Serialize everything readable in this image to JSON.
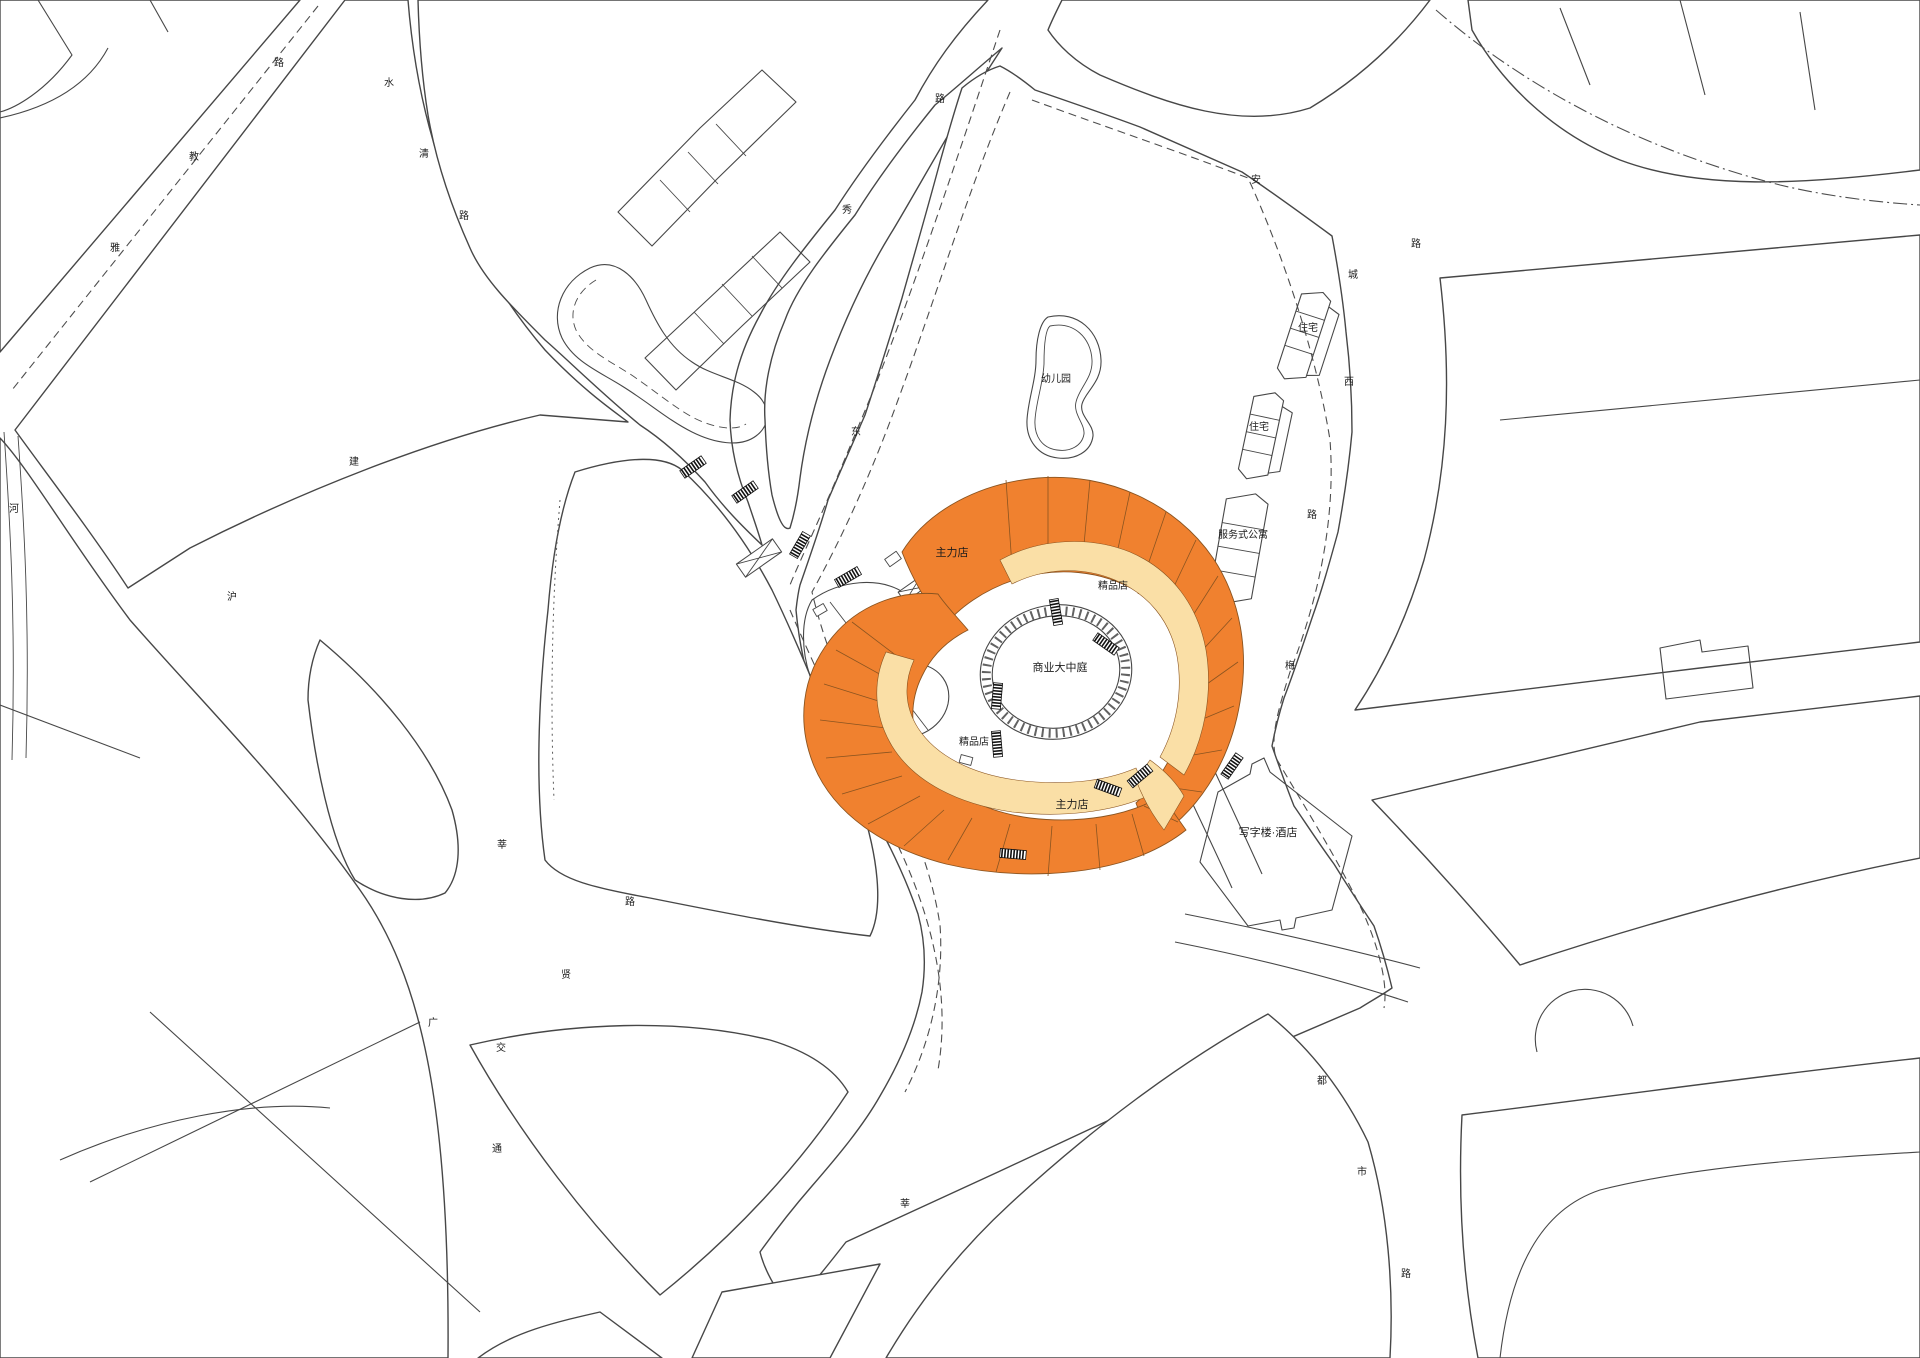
{
  "title": "commercial-complex-site-plan",
  "colors": {
    "orange": "#F0812F",
    "cream": "#FADFA6",
    "line": "#474747"
  },
  "mall": {
    "atrium_label": "商业大中庭",
    "anchor_store_label": "主力店",
    "boutique_label": "精品店"
  },
  "site_labels": [
    {
      "text": "幼儿园",
      "x": 1056,
      "y": 382,
      "size": 10
    },
    {
      "text": "住宅",
      "x": 1308,
      "y": 331,
      "size": 10
    },
    {
      "text": "住宅",
      "x": 1259,
      "y": 430,
      "size": 10
    },
    {
      "text": "服务式公寓",
      "x": 1243,
      "y": 538,
      "size": 10
    },
    {
      "text": "写字楼·酒店",
      "x": 1268,
      "y": 836,
      "size": 11
    },
    {
      "text": "主力店",
      "x": 952,
      "y": 556,
      "size": 11
    },
    {
      "text": "精品店",
      "x": 1113,
      "y": 589,
      "size": 10
    },
    {
      "text": "商业大中庭",
      "x": 1060,
      "y": 671,
      "size": 11
    },
    {
      "text": "精品店",
      "x": 974,
      "y": 745,
      "size": 10
    },
    {
      "text": "主力店",
      "x": 1072,
      "y": 808,
      "size": 11
    }
  ],
  "road_labels": [
    {
      "text": "路",
      "x": 279,
      "y": 66
    },
    {
      "text": "教",
      "x": 194,
      "y": 160
    },
    {
      "text": "雅",
      "x": 115,
      "y": 251
    },
    {
      "text": "水",
      "x": 389,
      "y": 86
    },
    {
      "text": "清",
      "x": 424,
      "y": 157
    },
    {
      "text": "路",
      "x": 464,
      "y": 219
    },
    {
      "text": "路",
      "x": 940,
      "y": 102
    },
    {
      "text": "秀",
      "x": 847,
      "y": 213
    },
    {
      "text": "东",
      "x": 856,
      "y": 435
    },
    {
      "text": "安",
      "x": 1256,
      "y": 183
    },
    {
      "text": "路",
      "x": 1416,
      "y": 247
    },
    {
      "text": "城",
      "x": 1353,
      "y": 278
    },
    {
      "text": "西",
      "x": 1349,
      "y": 385
    },
    {
      "text": "路",
      "x": 1312,
      "y": 518
    },
    {
      "text": "梅",
      "x": 1290,
      "y": 669
    },
    {
      "text": "河",
      "x": 14,
      "y": 512
    },
    {
      "text": "建",
      "x": 354,
      "y": 465
    },
    {
      "text": "沪",
      "x": 232,
      "y": 600
    },
    {
      "text": "莘",
      "x": 502,
      "y": 848
    },
    {
      "text": "路",
      "x": 630,
      "y": 905
    },
    {
      "text": "贤",
      "x": 566,
      "y": 978
    },
    {
      "text": "广",
      "x": 433,
      "y": 1026
    },
    {
      "text": "交",
      "x": 501,
      "y": 1051
    },
    {
      "text": "通",
      "x": 497,
      "y": 1152
    },
    {
      "text": "莘",
      "x": 905,
      "y": 1207
    },
    {
      "text": "都",
      "x": 1322,
      "y": 1084
    },
    {
      "text": "市",
      "x": 1362,
      "y": 1175
    },
    {
      "text": "路",
      "x": 1406,
      "y": 1277
    }
  ]
}
